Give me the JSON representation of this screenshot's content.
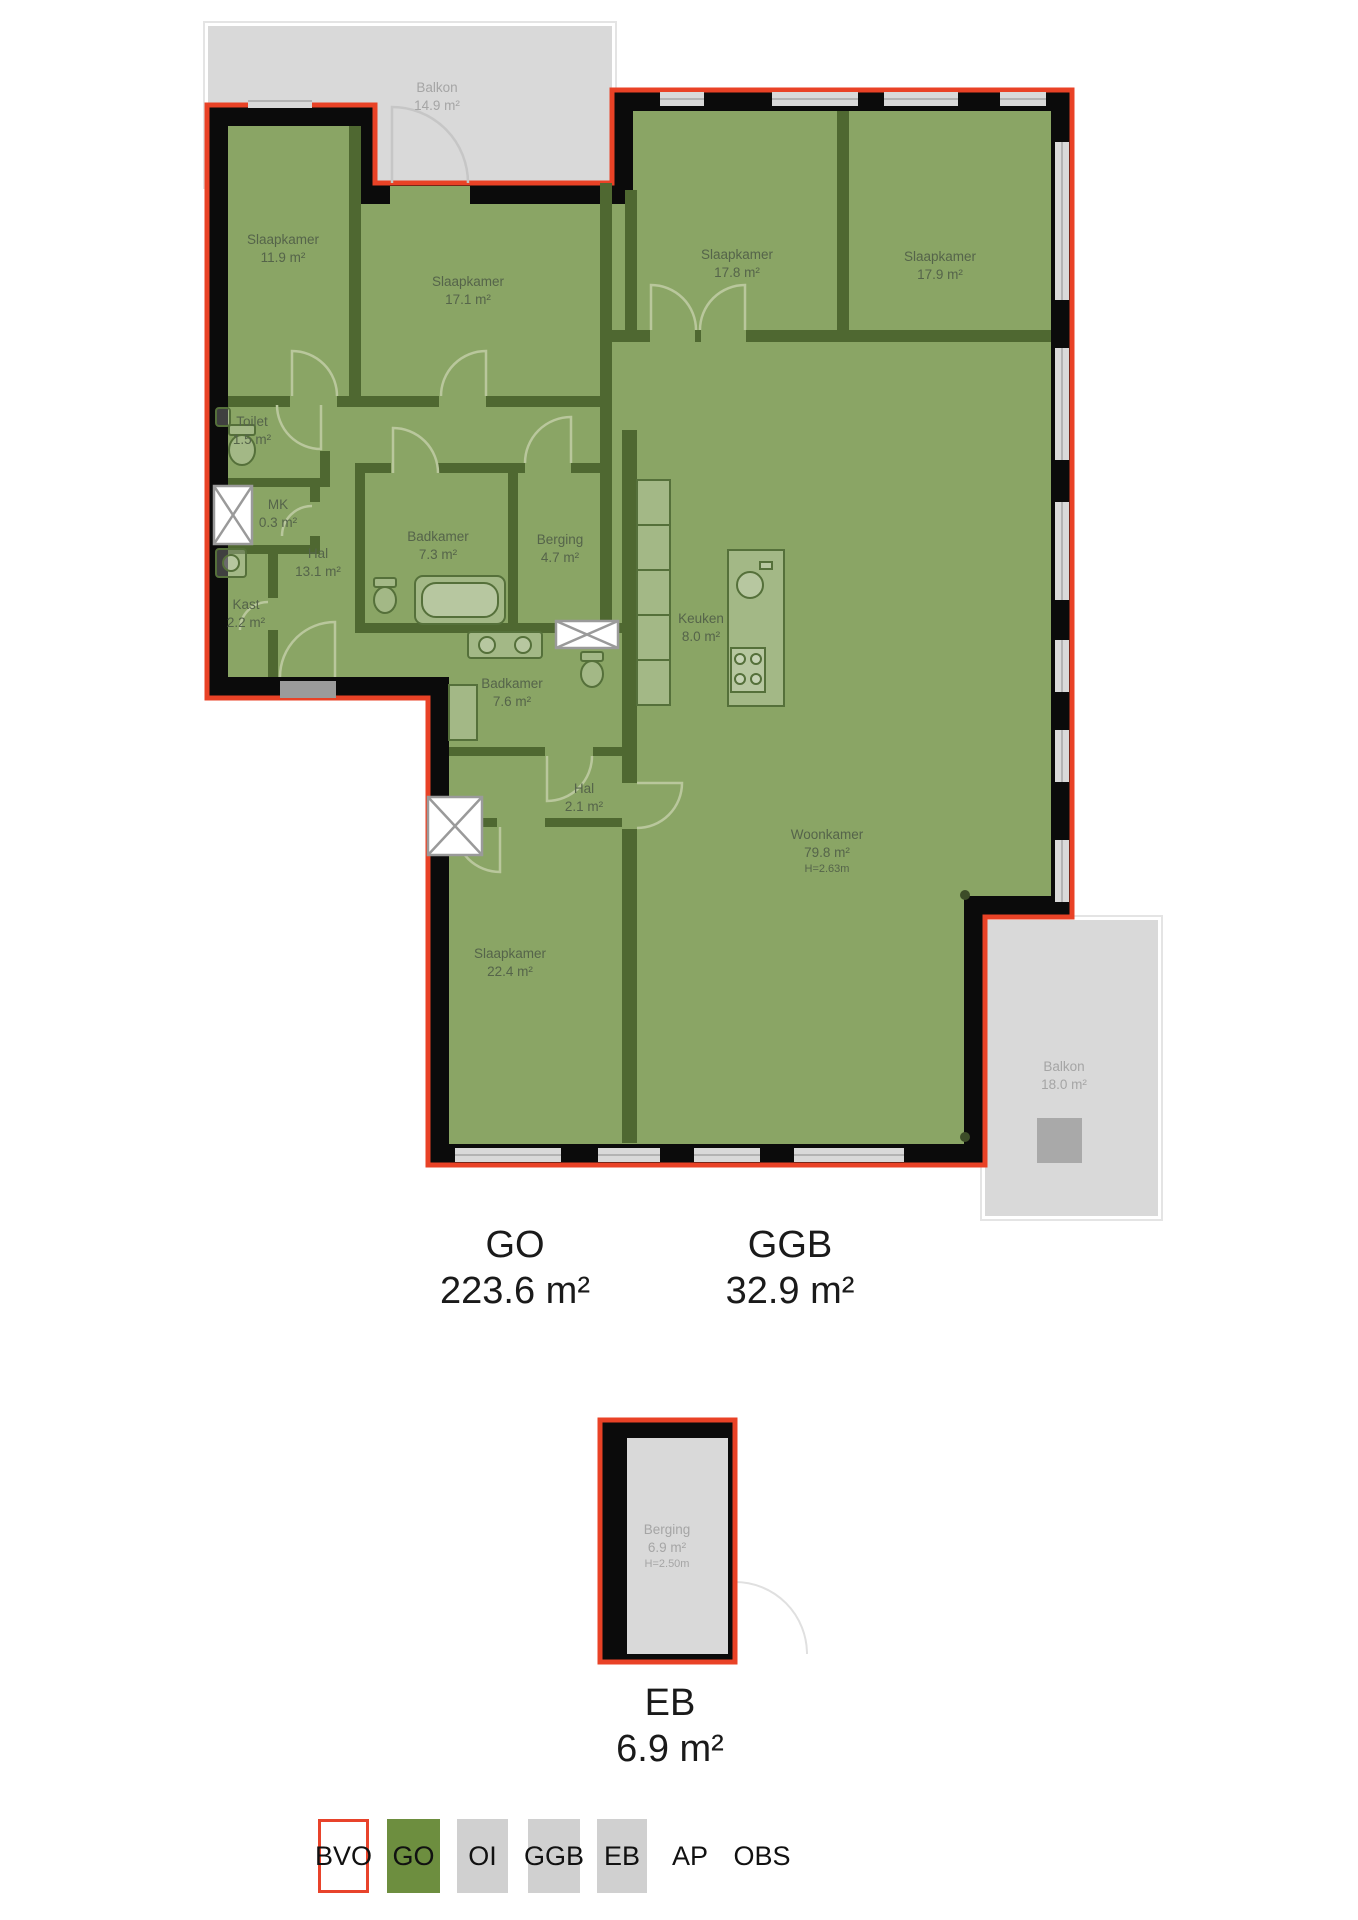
{
  "rooms": [
    {
      "name": "Balkon",
      "area": "14.9 m²"
    },
    {
      "name": "Slaapkamer",
      "area": "11.9 m²"
    },
    {
      "name": "Slaapkamer",
      "area": "17.1 m²"
    },
    {
      "name": "Slaapkamer",
      "area": "17.8 m²"
    },
    {
      "name": "Slaapkamer",
      "area": "17.9 m²"
    },
    {
      "name": "Toilet",
      "area": "1.5 m²"
    },
    {
      "name": "MK",
      "area": "0.3 m²"
    },
    {
      "name": "Hal",
      "area": "13.1 m²"
    },
    {
      "name": "Kast",
      "area": "2.2 m²"
    },
    {
      "name": "Badkamer",
      "area": "7.3 m²"
    },
    {
      "name": "Berging",
      "area": "4.7 m²"
    },
    {
      "name": "Keuken",
      "area": "8.0 m²"
    },
    {
      "name": "Badkamer",
      "area": "7.6 m²"
    },
    {
      "name": "Hal",
      "area": "2.1 m²"
    },
    {
      "name": "Woonkamer",
      "area": "79.8 m²",
      "height": "H=2.63m"
    },
    {
      "name": "Slaapkamer",
      "area": "22.4 m²"
    },
    {
      "name": "Balkon",
      "area": "18.0 m²"
    },
    {
      "name": "Berging",
      "area": "6.9 m²",
      "height": "H=2.50m"
    }
  ],
  "summaries": {
    "go": {
      "code": "GO",
      "area": "223.6 m²"
    },
    "ggb": {
      "code": "GGB",
      "area": "32.9 m²"
    },
    "eb": {
      "code": "EB",
      "area": "6.9 m²"
    }
  },
  "legend": [
    {
      "label": "BVO"
    },
    {
      "label": "GO"
    },
    {
      "label": "OI"
    },
    {
      "label": "GGB"
    },
    {
      "label": "EB"
    },
    {
      "label": "AP"
    },
    {
      "label": "OBS"
    }
  ],
  "colors": {
    "outline_red": "#e94226",
    "room_green": "#8aa565",
    "wall_green": "#4f6831",
    "wall_black": "#0b0b0b",
    "balcony_gray": "#d9d9d9",
    "legend_green": "#6d8e3f",
    "legend_gray": "#d0d0d0"
  }
}
